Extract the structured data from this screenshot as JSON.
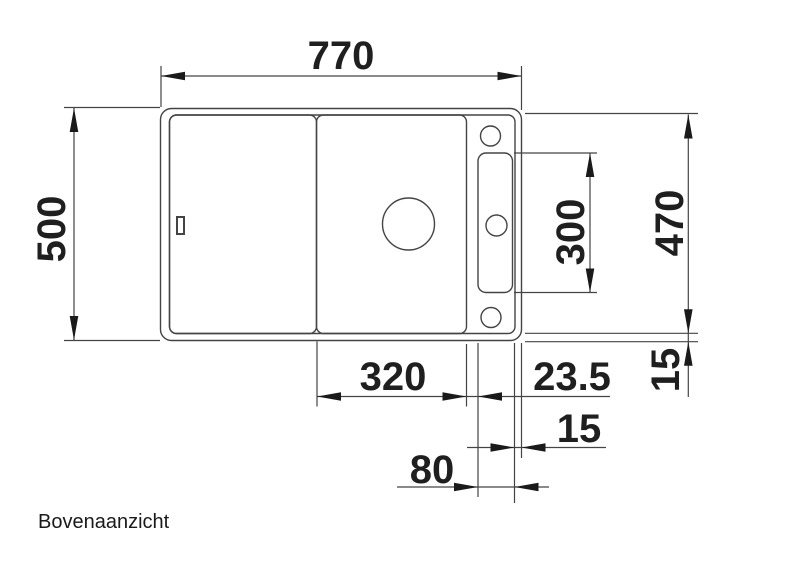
{
  "drawing": {
    "view_label": "Bovenaanzicht",
    "dims": {
      "overall_width": "770",
      "overall_depth": "500",
      "inner_depth": "470",
      "ledge_recess_length": "300",
      "bowl_width": "320",
      "bowl_to_ledge": "23.5",
      "ledge_to_edge": "15",
      "rim_bottom": "15",
      "ledge_width": "80"
    },
    "colors": {
      "line": "#444444",
      "arrow": "#1a1a1a",
      "text": "#1f1f1f",
      "background": "#ffffff"
    }
  }
}
